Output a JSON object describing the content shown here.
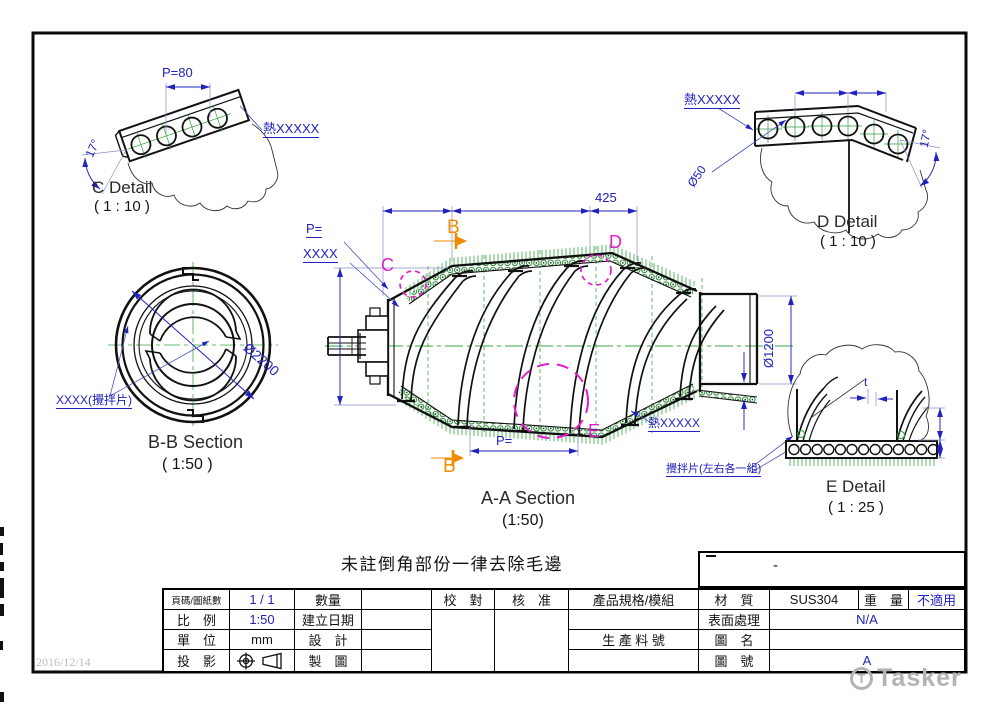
{
  "sheet": {
    "date_stamp": "2016/12/14",
    "general_note": "未註倒角部份一律去除毛邊",
    "watermark_text": "Tasker",
    "watermark_logo": "T",
    "part_box_mark": "-"
  },
  "views": {
    "c_detail": {
      "title": "C Detail",
      "scale": "( 1 : 10 )",
      "pitch": "P=80",
      "angle": "17°",
      "heat_label": "熱XXXXX"
    },
    "d_detail": {
      "title": "D Detail",
      "scale": "( 1 : 10 )",
      "hole_dia": "Ø50",
      "angle": "17°",
      "heat_label": "熱XXXXX"
    },
    "bb_section": {
      "title": "B-B Section",
      "scale": "( 1:50 )",
      "dia": "Ø2200",
      "blade_label": "XXXX(攪拌片)"
    },
    "aa_section": {
      "title": "A-A Section",
      "scale": "(1:50)",
      "dim_right": "425",
      "outlet_dia": "Ø1200",
      "pitch_top_line1": "P=",
      "pitch_top_line2": "XXXX",
      "pitch_bottom": "P=",
      "heat_label": "熱XXXXX",
      "blade_label": "攪拌片(左右各一組)",
      "marker_b": "B",
      "marker_c": "C",
      "marker_d": "D",
      "marker_e": "E"
    },
    "e_detail": {
      "title": "E Detail",
      "scale": "( 1 : 25 )",
      "thickness": "t"
    }
  },
  "title_block": {
    "page_label": "頁碼/圖紙數",
    "page_value": "1 / 1",
    "qty_label": "數量",
    "scale_label": "比　例",
    "scale_value": "1:50",
    "date_label": "建立日期",
    "unit_label": "單　位",
    "unit_value": "mm",
    "design_label": "設　計",
    "projection_label": "投　影",
    "draft_label": "製　圖",
    "check_label": "校　對",
    "approve_label": "核　准",
    "spec_label": "產品規格/模組",
    "material_label": "材　質",
    "material_value": "SUS304",
    "weight_label": "重　量",
    "weight_value": "不適用",
    "surface_label": "表面處理",
    "surface_value": "N/A",
    "partno_label": "生 產 料 號",
    "name_label": "圖　名",
    "number_label": "圖　號",
    "number_value": "A"
  },
  "colors": {
    "dimension_blue": "#2121c0",
    "detail_magenta": "#e31ec8",
    "section_orange": "#ef8b00",
    "centerline_green": "#3aa843",
    "hatch_green": "#1c7a28"
  }
}
